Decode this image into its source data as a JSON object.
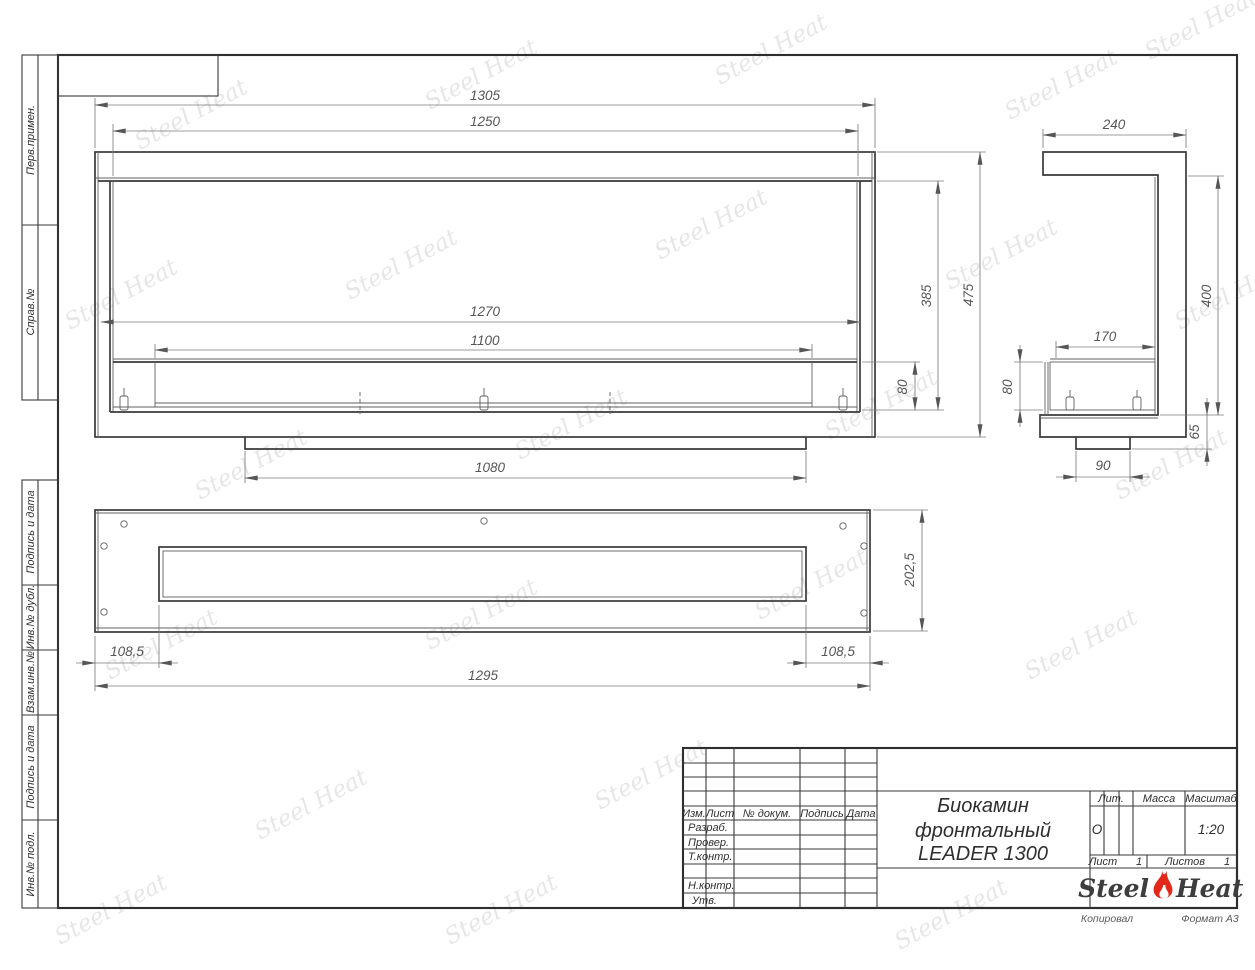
{
  "left_margin": {
    "top_labels": [
      "Перв.примен.",
      "Справ.№"
    ],
    "bottom_labels": [
      "Подпись и дата",
      "Инв.№ дубл.",
      "Взам.инв.№",
      "Подпись и дата",
      "Инв.№ подл."
    ]
  },
  "views": {
    "front": {
      "w_outer": "1305",
      "w_top": "1250",
      "w_glass": "1270",
      "w_burner": "1100",
      "w_foot": "1080",
      "h_glass": "385",
      "h_outer": "475",
      "h_burner": "80"
    },
    "side": {
      "depth": "240",
      "burner_depth": "170",
      "height": "400",
      "burner_h": "80",
      "bottom_h": "65",
      "foot": "90"
    },
    "top": {
      "offset_left": "108,5",
      "offset_right": "108,5",
      "width": "1295",
      "depth": "202,5"
    }
  },
  "title_block": {
    "col_izm": "Изм.",
    "col_list": "Лист",
    "col_doc": "№ докум.",
    "col_sign": "Подпись",
    "col_date": "Дата",
    "row_razrab": "Разраб.",
    "row_prover": "Провер.",
    "row_tkontr": "Т.контр.",
    "row_nkontr": "Н.контр.",
    "row_utv": "Утв.",
    "title_line1": "Биокамин",
    "title_line2": "фронтальный",
    "title_line3": "LEADER 1300",
    "lit_label": "Лит.",
    "mass_label": "Масса",
    "scale_label": "Масштаб",
    "lit_value": "О",
    "scale_value": "1:20",
    "sheet_label": "Лист",
    "sheet_value": "1",
    "sheets_label": "Листов",
    "sheets_value": "1",
    "logo_steel": "Steel",
    "logo_heat": "Heat",
    "footer_copy": "Копировал",
    "footer_format": "Формат А3"
  },
  "watermark": {
    "text": "Steel Heat"
  }
}
